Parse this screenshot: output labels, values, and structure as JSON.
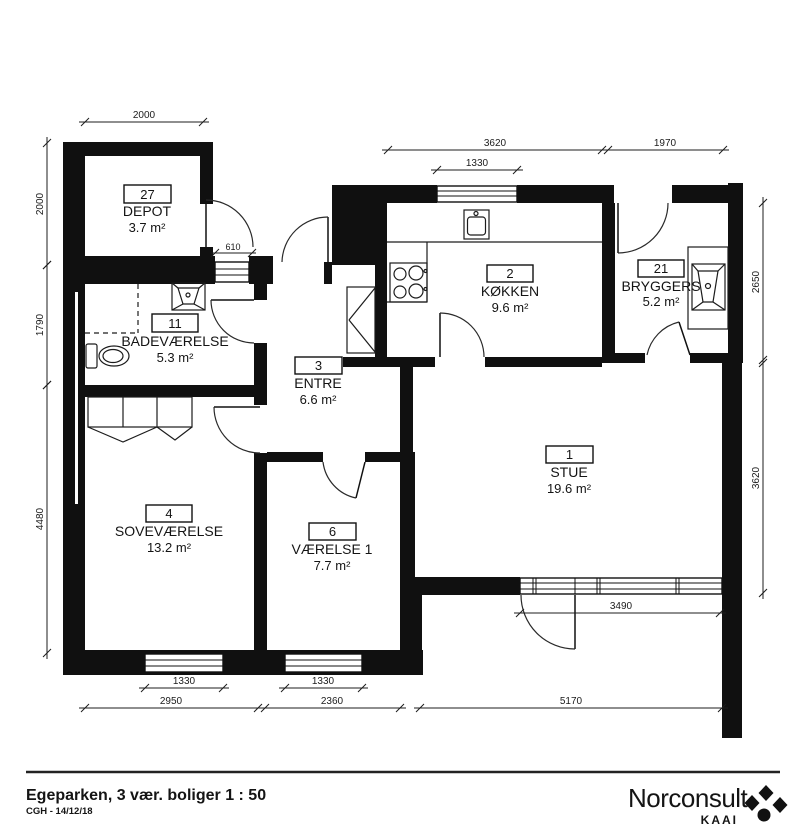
{
  "plan": {
    "rooms": [
      {
        "number": "27",
        "name": "DEPOT",
        "area": "3.7 m²"
      },
      {
        "number": "11",
        "name": "BADEVÆRELSE",
        "area": "5.3 m²"
      },
      {
        "number": "3",
        "name": "ENTRE",
        "area": "6.6 m²"
      },
      {
        "number": "2",
        "name": "KØKKEN",
        "area": "9.6 m²"
      },
      {
        "number": "21",
        "name": "BRYGGERS",
        "area": "5.2 m²"
      },
      {
        "number": "1",
        "name": "STUE",
        "area": "19.6 m²"
      },
      {
        "number": "4",
        "name": "SOVEVÆRELSE",
        "area": "13.2 m²"
      },
      {
        "number": "6",
        "name": "VÆRELSE 1",
        "area": "7.7 m²"
      }
    ],
    "dimensions": {
      "top_depot": "2000",
      "top_kitchen": "3620",
      "top_bryggers": "1970",
      "top_kitchen_window": "1330",
      "hall_window": "610",
      "left_depot": "2000",
      "left_bath": "1790",
      "left_bedroom": "4480",
      "right_bryggers": "2650",
      "right_stue": "3620",
      "bottom_window_sove": "1330",
      "bottom_window_vaer": "1330",
      "bottom_sove": "2950",
      "bottom_vaer": "2360",
      "bottom_stue": "5170",
      "stue_windows": "3490"
    }
  },
  "footer": {
    "title": "Egeparken, 3 vær. boliger  1 : 50",
    "credit": "CGH - 14/12/18",
    "brand": "Norconsult",
    "brand_sub": "KAAI"
  }
}
